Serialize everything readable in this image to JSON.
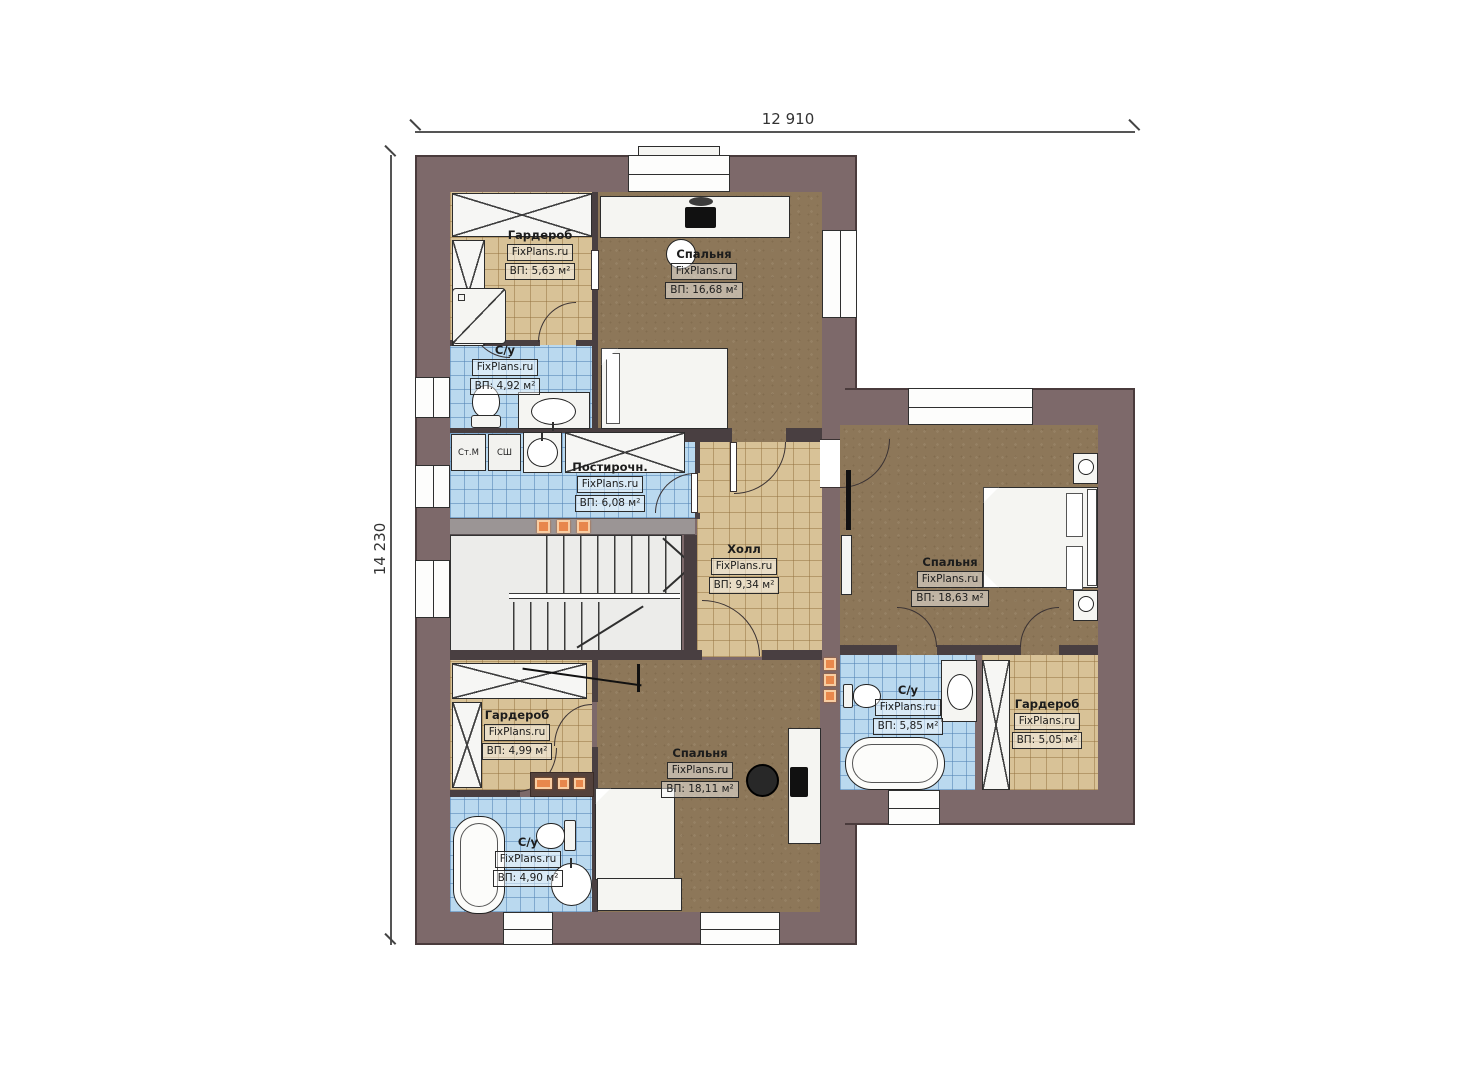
{
  "brand": "FixPlans.ru",
  "dimensions": {
    "top": "12 910",
    "left": "14 230"
  },
  "rooms": [
    {
      "id": "wardrobe-top-left",
      "name": "Гардероб",
      "area": "ВП: 5,63 м²"
    },
    {
      "id": "bedroom-top",
      "name": "Спальня",
      "area": "ВП: 16,68 м²"
    },
    {
      "id": "bathroom-top-left",
      "name": "С/у",
      "area": "ВП: 4,92 м²"
    },
    {
      "id": "laundry",
      "name": "Постирочн.",
      "area": "ВП: 6,08 м²"
    },
    {
      "id": "hall",
      "name": "Холл",
      "area": "ВП: 9,34 м²"
    },
    {
      "id": "bedroom-right",
      "name": "Спальня",
      "area": "ВП: 18,63 м²"
    },
    {
      "id": "wardrobe-bottom-left",
      "name": "Гардероб",
      "area": "ВП: 4,99 м²"
    },
    {
      "id": "bedroom-bottom",
      "name": "Спальня",
      "area": "ВП: 18,11 м²"
    },
    {
      "id": "bathroom-bottom-right",
      "name": "С/у",
      "area": "ВП: 5,85 м²"
    },
    {
      "id": "wardrobe-bottom-right",
      "name": "Гардероб",
      "area": "ВП: 5,05 м²"
    },
    {
      "id": "bathroom-bottom-left",
      "name": "С/у",
      "area": "ВП: 4,90 м²"
    }
  ],
  "appliances": {
    "washer": "Ст.М",
    "dryer": "СШ"
  },
  "colors": {
    "wall": "#7d696a",
    "wall_edge": "#4a3b3c",
    "floor_wood": "#8d7759",
    "tile_tan": "#d8c297",
    "tile_blue": "#bad9ef",
    "accent_lamp": "#e8874c"
  }
}
